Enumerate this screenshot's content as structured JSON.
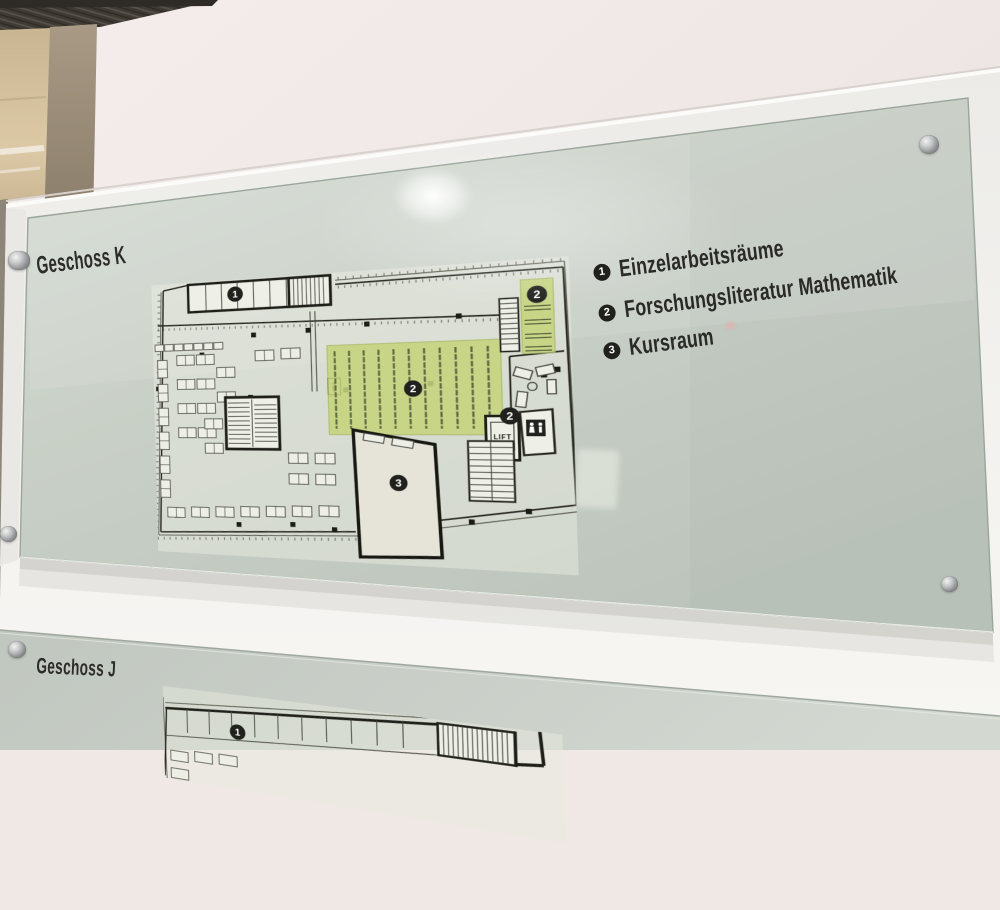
{
  "signs": {
    "upper": {
      "title": "Geschoss K",
      "legend": [
        {
          "num": "1",
          "label": "Einzelarbeitsräume"
        },
        {
          "num": "2",
          "label": "Forschungsliteratur Mathematik"
        },
        {
          "num": "3",
          "label": "Kursraum"
        }
      ],
      "plan_badges": {
        "single_rooms": "1",
        "shelves_main": "2",
        "shelves_side": "2",
        "shelves_entry": "2",
        "course_room": "3"
      },
      "plan_labels": {
        "lift": "LIFT"
      }
    },
    "lower": {
      "title": "Geschoss J",
      "plan_badges": {
        "single_rooms": "1"
      }
    }
  },
  "icons": {
    "standoff": "standoff-screw",
    "wc": "wc-figures",
    "elevator": "person-in-lift",
    "light": "ceiling-light-reflection"
  },
  "colors": {
    "glass": "#c9d0c7",
    "shelf_green": "#c5d37b",
    "badge": "#20201c",
    "board": "#f2f1ee",
    "wall": "#f1eae7",
    "steel": "#aeb0b1"
  }
}
